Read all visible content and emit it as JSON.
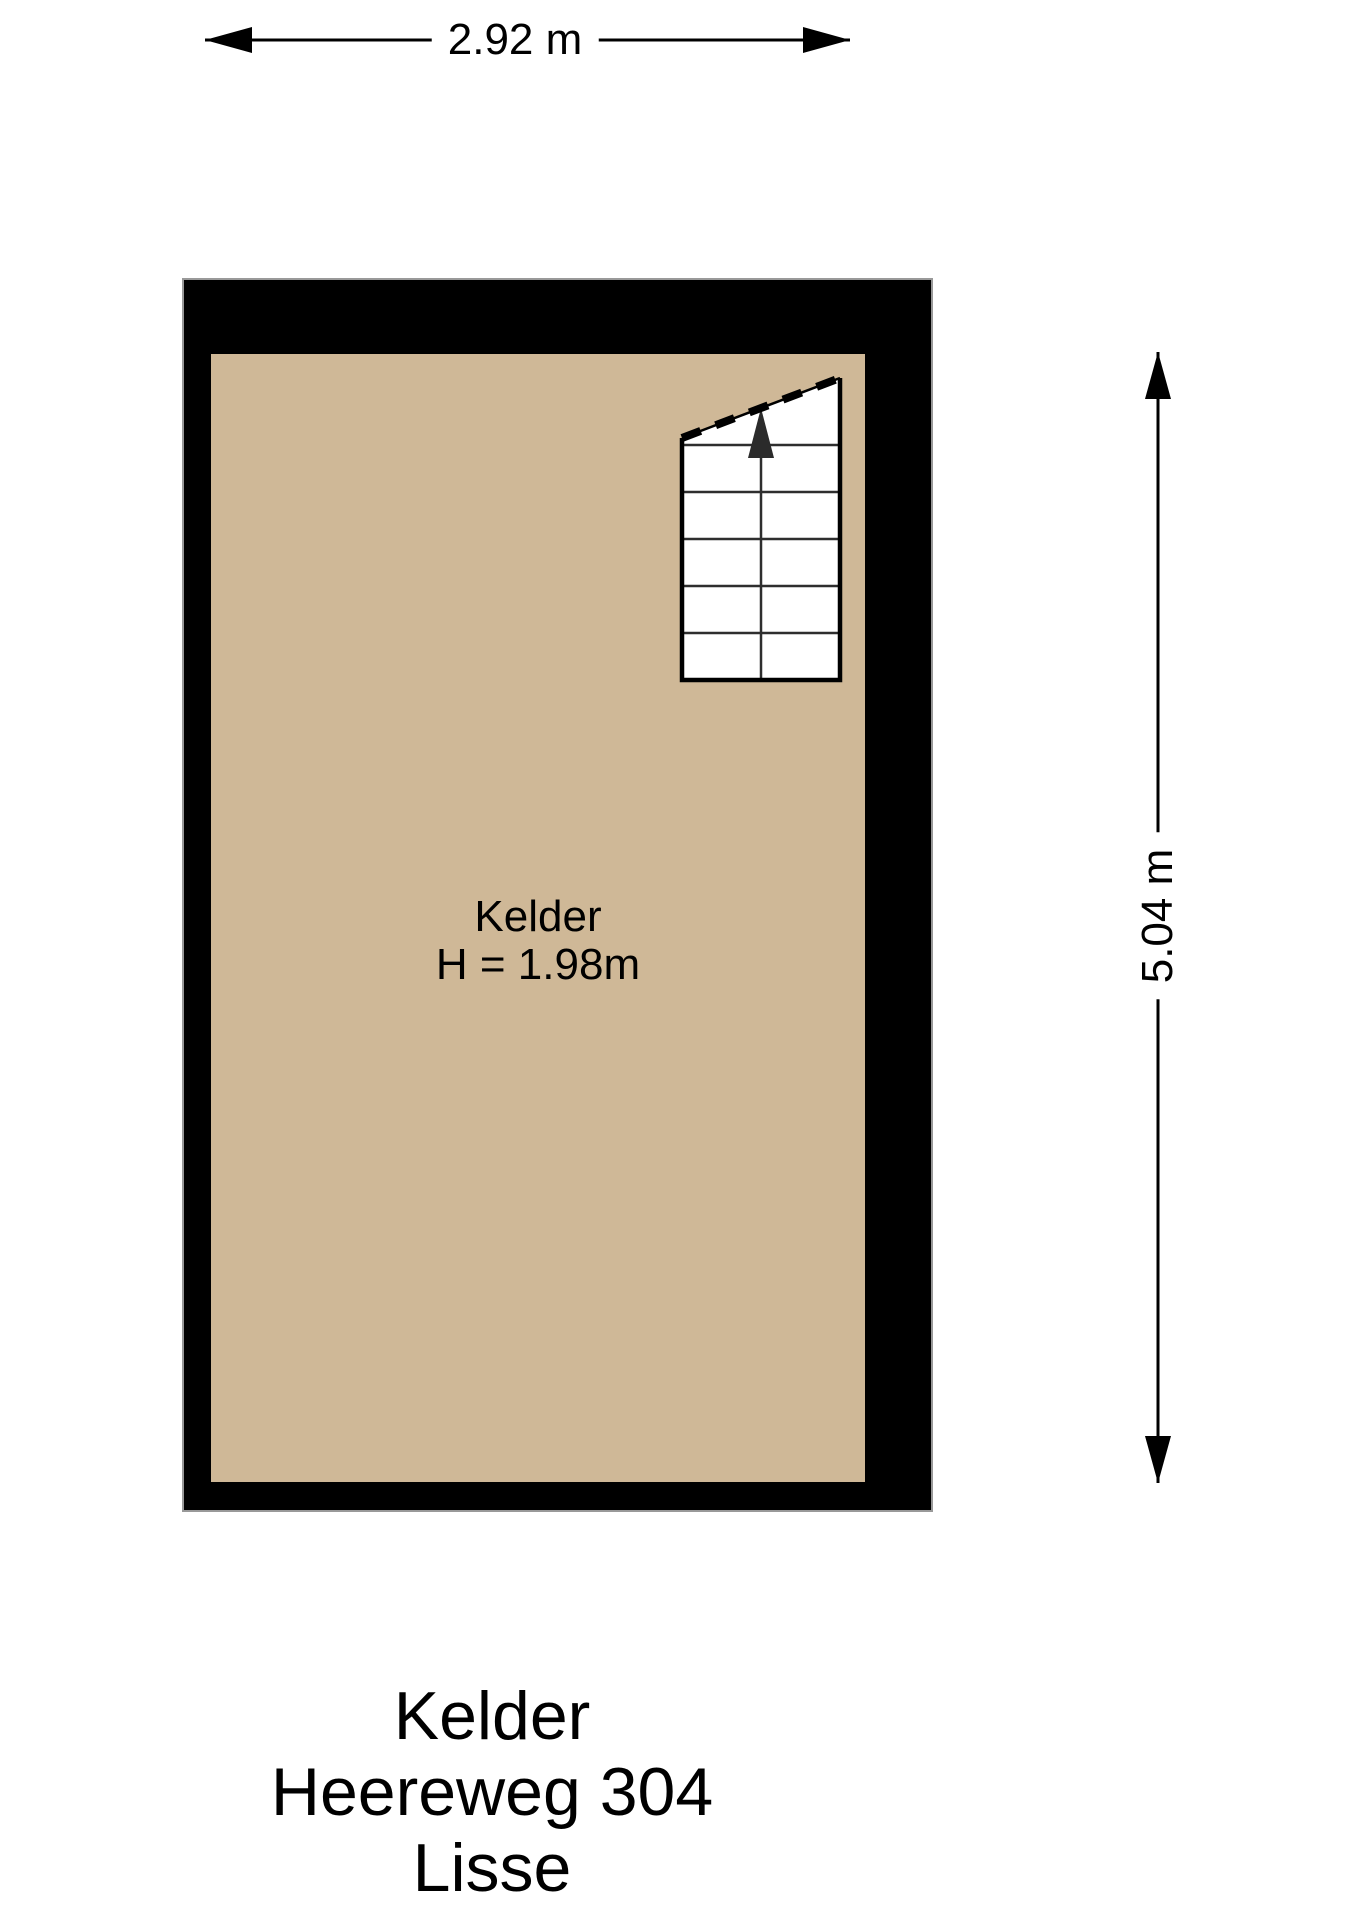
{
  "plan": {
    "room_label": "Kelder",
    "room_height_label": "H = 1.98m",
    "floor_color": "#cfb897",
    "wall_color": "#000000"
  },
  "dimensions": {
    "width_label": "2.92 m",
    "height_label": "5.04 m"
  },
  "title": {
    "line1": "Kelder",
    "line2": "Heereweg 304",
    "line3": "Lisse"
  }
}
